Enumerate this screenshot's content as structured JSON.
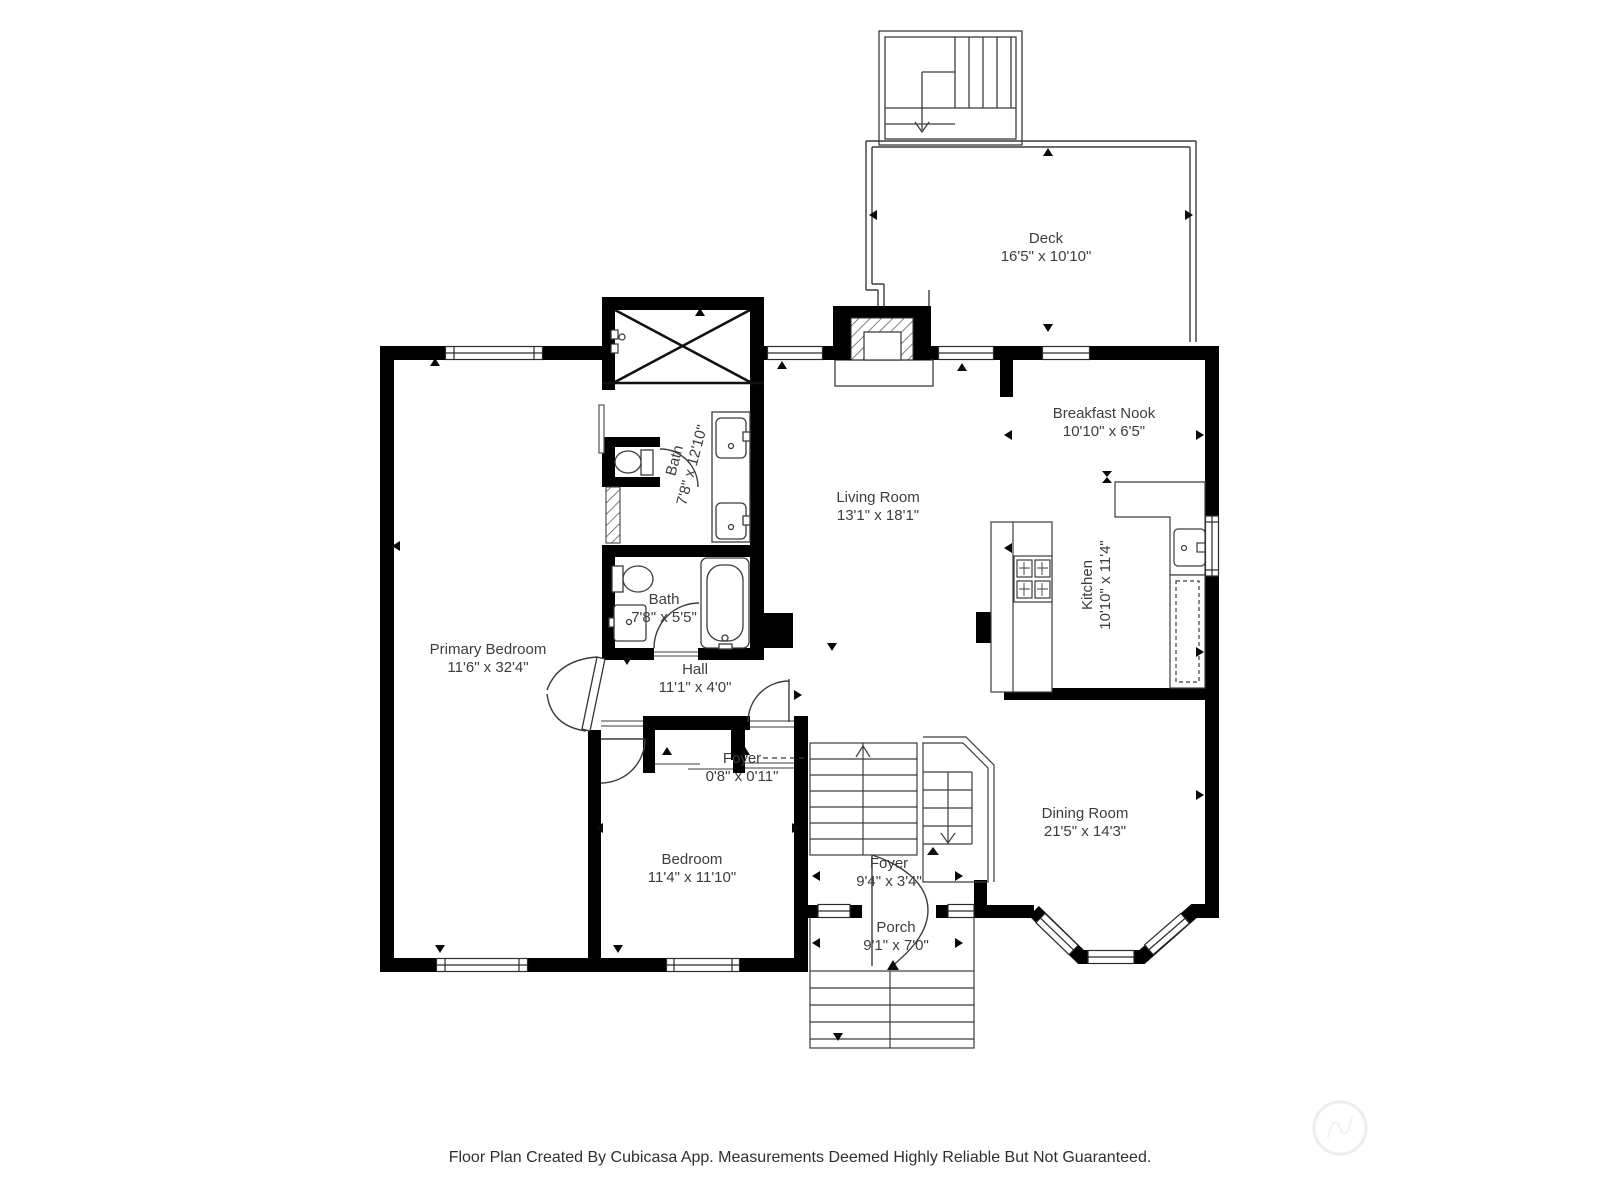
{
  "title": "Floor Plan",
  "colors": {
    "wall": "#000000",
    "thin_line": "#3c3c3c",
    "text": "#3d3d3d",
    "background": "#ffffff",
    "watermark": "#ededed"
  },
  "rooms": {
    "deck": {
      "name": "Deck",
      "dims": "16'5\" x 10'10\""
    },
    "breakfast_nook": {
      "name": "Breakfast Nook",
      "dims": "10'10\" x 6'5\""
    },
    "living_room": {
      "name": "Living Room",
      "dims": "13'1\" x 18'1\""
    },
    "bath_upper": {
      "name": "Bath",
      "dims": "7'8\" x 12'10\""
    },
    "bath_lower": {
      "name": "Bath",
      "dims": "7'8\" x 5'5\""
    },
    "primary_bedroom": {
      "name": "Primary Bedroom",
      "dims": "11'6\" x 32'4\""
    },
    "hall": {
      "name": "Hall",
      "dims": "11'1\" x 4'0\""
    },
    "kitchen": {
      "name": "Kitchen",
      "dims": "10'10\" x 11'4\""
    },
    "foyer_small": {
      "name": "Foyer",
      "dims": "0'8\" x 0'11\""
    },
    "bedroom": {
      "name": "Bedroom",
      "dims": "11'4\" x 11'10\""
    },
    "dining_room": {
      "name": "Dining Room",
      "dims": "21'5\" x 14'3\""
    },
    "foyer": {
      "name": "Foyer",
      "dims": "9'4\" x 3'4\""
    },
    "porch": {
      "name": "Porch",
      "dims": "9'1\" x 7'0\""
    }
  },
  "footer": {
    "text": "Floor Plan Created By Cubicasa App. Measurements Deemed Highly Reliable But Not Guaranteed."
  }
}
